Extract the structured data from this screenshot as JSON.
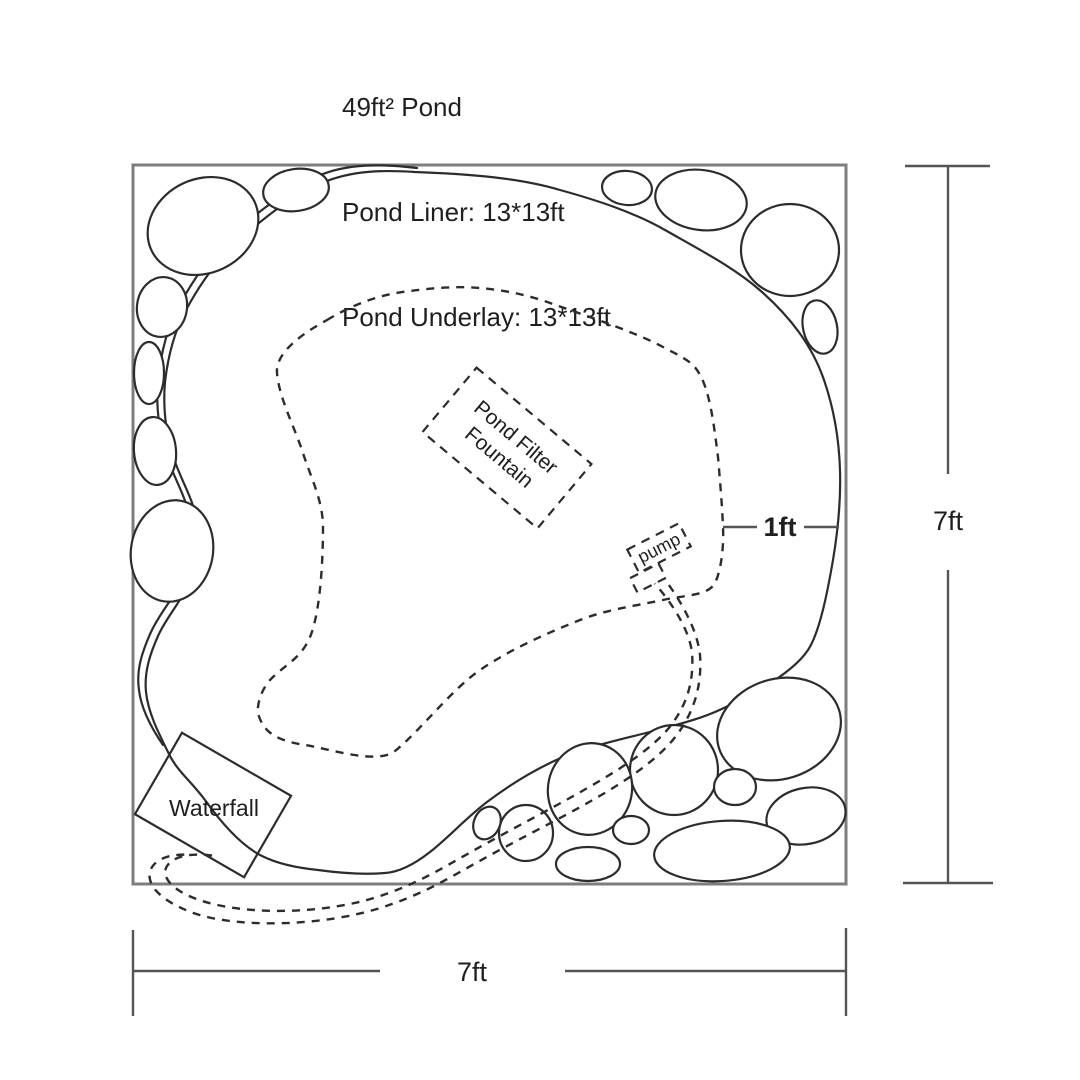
{
  "title": {
    "line1": "49ft² Pond",
    "line2": "Pond Liner: 13*13ft",
    "line3": "Pond Underlay: 13*13ft"
  },
  "labels": {
    "filter_line1": "Pond Filter",
    "filter_line2": "Fountain",
    "pump": "pump",
    "waterfall": "Waterfall",
    "offset": "1ft",
    "height": "7ft",
    "width": "7ft"
  },
  "colors": {
    "ink": "#2c2c2c",
    "frame": "#7d7d7d",
    "dim": "#555555",
    "background": "#ffffff",
    "text": "#1f1f1f"
  }
}
